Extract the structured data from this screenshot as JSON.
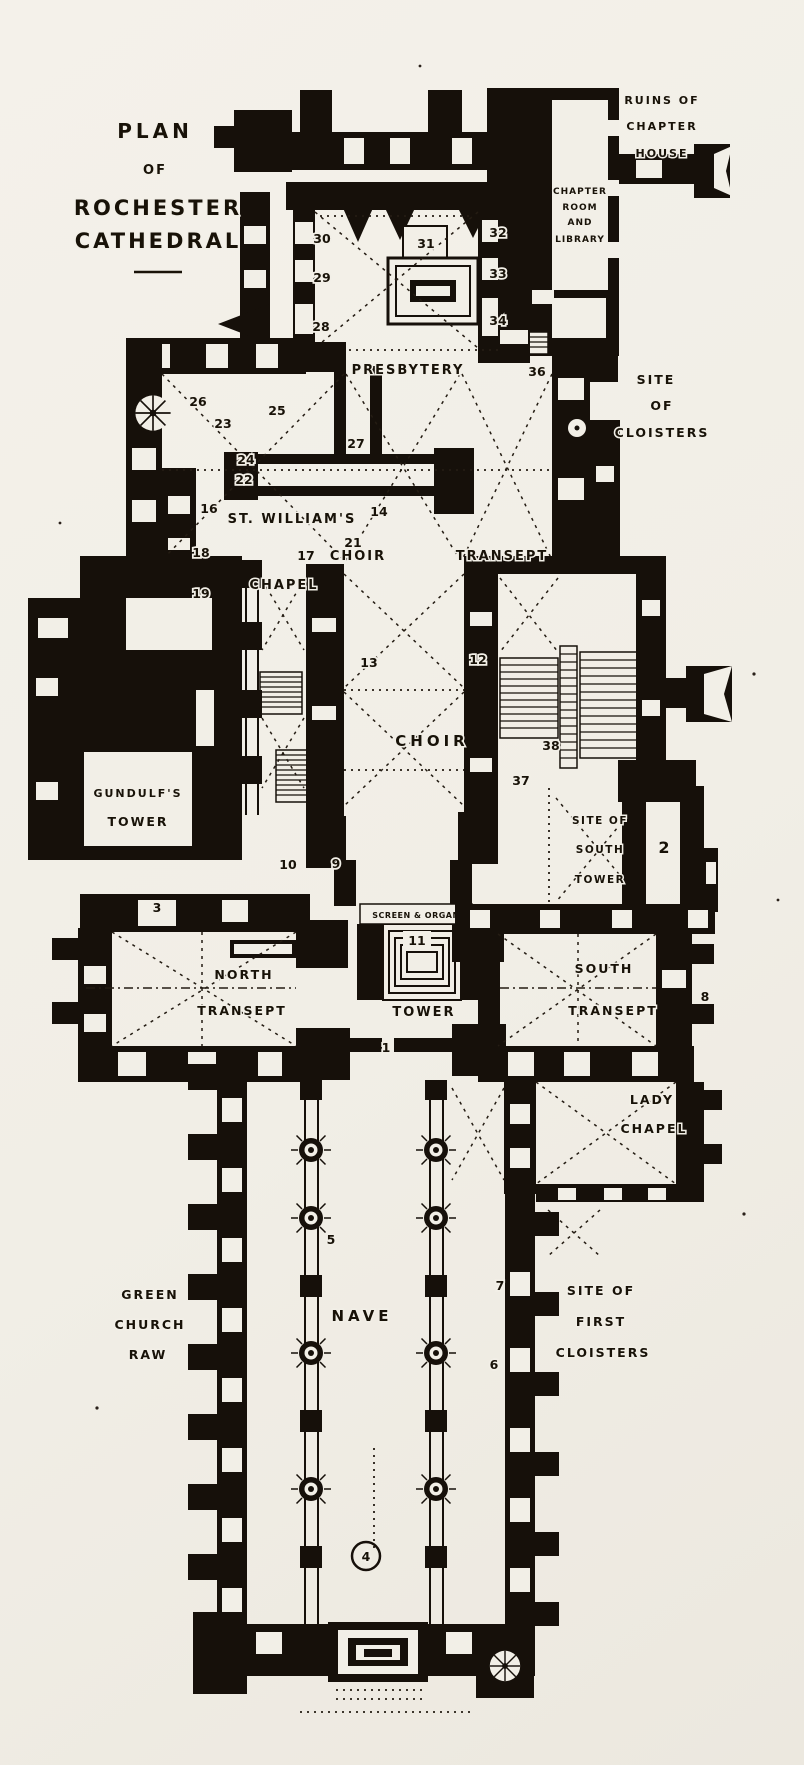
{
  "title": {
    "lines": [
      "PLAN",
      "OF",
      "ROCHESTER",
      "CATHEDRAL"
    ]
  },
  "labels": {
    "ruins_chapter_house": [
      "RUINS OF",
      "CHAPTER",
      "HOUSE"
    ],
    "chapter_room_library": [
      "CHAPTER",
      "ROOM",
      "AND",
      "LIBRARY"
    ],
    "presbytery": "PRESBYTERY",
    "site_of_cloisters": [
      "SITE",
      "OF",
      "CLOISTERS"
    ],
    "st_williams_chapel": [
      "ST. WILLIAM'S",
      "CHAPEL"
    ],
    "choir_transept": {
      "choir": "CHOIR",
      "transept": "TRANSEPT"
    },
    "choir": "CHOIR",
    "gundulfs_tower": [
      "GUNDULF'S",
      "TOWER"
    ],
    "site_of_south_tower": [
      "SITE OF",
      "SOUTH",
      "TOWER"
    ],
    "screen_and_organ": "SCREEN & ORGAN",
    "north_transept": [
      "NORTH",
      "TRANSEPT"
    ],
    "tower": "TOWER",
    "south_transept": [
      "SOUTH",
      "TRANSEPT"
    ],
    "lady_chapel": [
      "LADY",
      "CHAPEL"
    ],
    "green_church": [
      "GREEN",
      "CHURCH",
      "RAW"
    ],
    "nave": "NAVE",
    "site_of_first_cloisters": [
      "SITE OF",
      "FIRST",
      "CLOISTERS"
    ]
  },
  "markers": {
    "m1": "1",
    "m2": "2",
    "m3": "3",
    "m4": "4",
    "m5": "5",
    "m6": "6",
    "m7": "7",
    "m8": "8",
    "m9": "9",
    "m10": "10",
    "m11": "11",
    "m12": "12",
    "m13": "13",
    "m14": "14",
    "m16": "16",
    "m17": "17",
    "m18": "18",
    "m19": "19",
    "m21": "21",
    "m22": "22",
    "m23": "23",
    "m24": "24",
    "m25": "25",
    "m26": "26",
    "m27": "27",
    "m28": "28",
    "m29": "29",
    "m30": "30",
    "m31": "31",
    "m32": "32",
    "m33": "33",
    "m34": "34",
    "m36": "36",
    "m37": "37",
    "m38": "38"
  },
  "colors": {
    "paper": "#f2efe7",
    "ink": "#16100a"
  }
}
